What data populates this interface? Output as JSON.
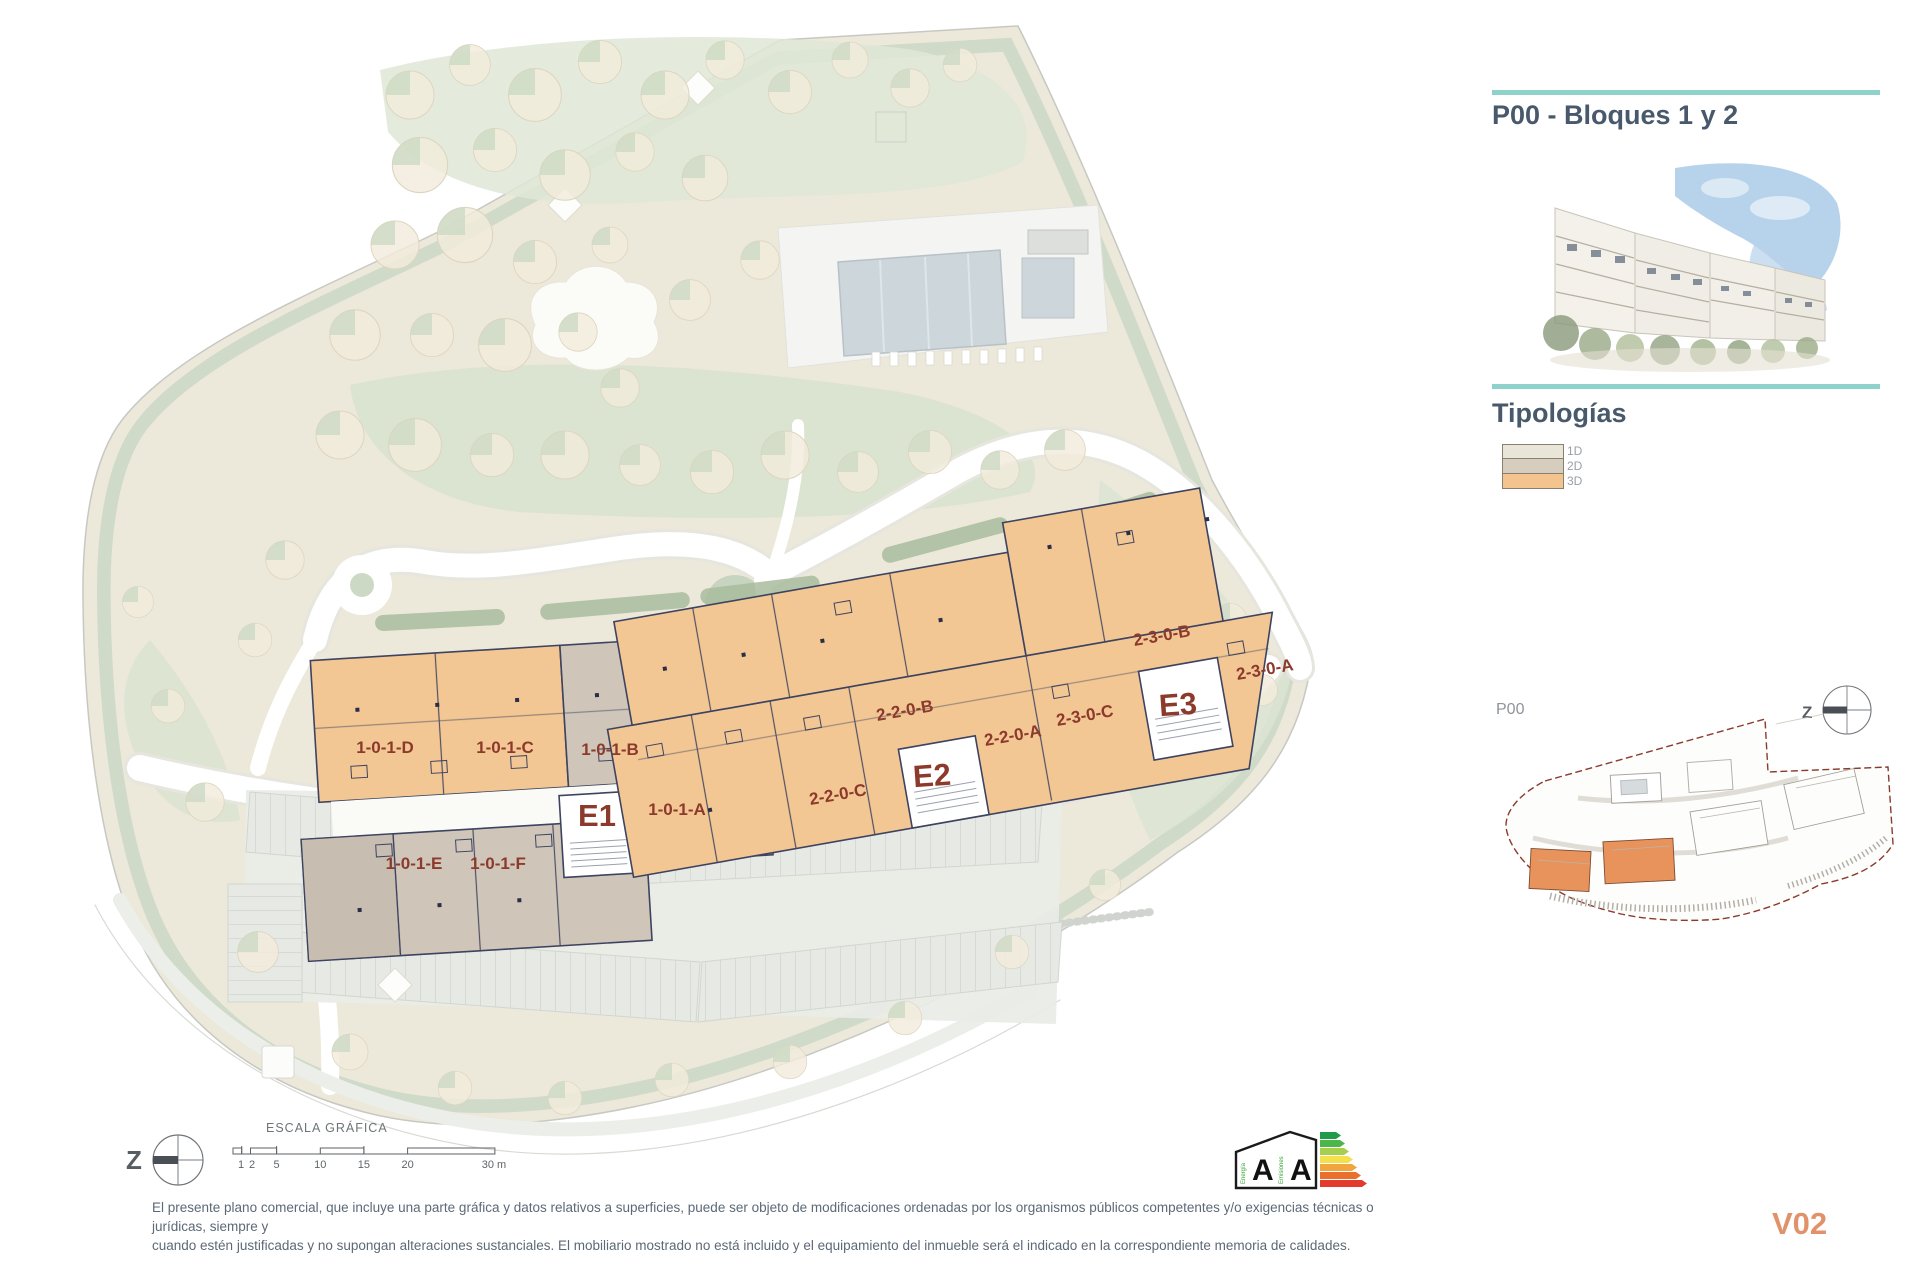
{
  "header": {
    "title": "P00 - Bloques 1 y 2"
  },
  "tipologias": {
    "heading": "Tipologías",
    "items": [
      {
        "label": "1D"
      },
      {
        "label": "2D"
      },
      {
        "label": "3D"
      }
    ]
  },
  "keyplan": {
    "label": "P00",
    "compass_letter": "Z"
  },
  "plan": {
    "compass_letter": "Z",
    "block1": {
      "core": "E1",
      "units": [
        "1-0-1-D",
        "1-0-1-C",
        "1-0-1-B",
        "1-0-1-A",
        "1-0-1-E",
        "1-0-1-F"
      ]
    },
    "block2": {
      "cores": [
        "E2",
        "E3"
      ],
      "units": [
        "2-2-0-C",
        "2-2-0-B",
        "2-2-0-A",
        "2-3-0-C",
        "2-3-0-B",
        "2-3-0-A"
      ]
    }
  },
  "scalebar": {
    "title": "ESCALA GRÁFICA",
    "tick_labels": [
      "1",
      "2",
      "5",
      "10",
      "15",
      "20",
      "30 m"
    ]
  },
  "energy": {
    "rating_letters": [
      "A",
      "A"
    ],
    "scale_labels": [
      "Energía",
      "Emisiones"
    ],
    "bar_colors": [
      "#1f9b49",
      "#4cb649",
      "#a5cf4c",
      "#f4e04b",
      "#f0a63c",
      "#ea6f2d",
      "#e23b2e"
    ]
  },
  "disclaimer": {
    "line1": "El presente plano comercial, que incluye una parte gráfica y datos relativos a superficies, puede ser objeto de modificaciones ordenadas por los organismos públicos competentes y/o exigencias técnicas o jurídicas, siempre y",
    "line2": "cuando estén justificadas y no supongan alteraciones sustanciales. El mobiliario mostrado no está incluido y el equipamiento del inmueble será el indicado en la correspondiente memoria de calidades."
  },
  "version": {
    "label": "V02"
  },
  "colors": {
    "accent_teal": "#8fd2cc",
    "unit_label_red": "#8c3a2c",
    "orange_3d": "#f3c793",
    "tan_2d": "#cfc6b9",
    "beige_1d": "#e9e5d8",
    "version_orange": "#e2926b",
    "wall_navy": "#3d4360",
    "keyplan_boundary": "#8a3b2e"
  }
}
